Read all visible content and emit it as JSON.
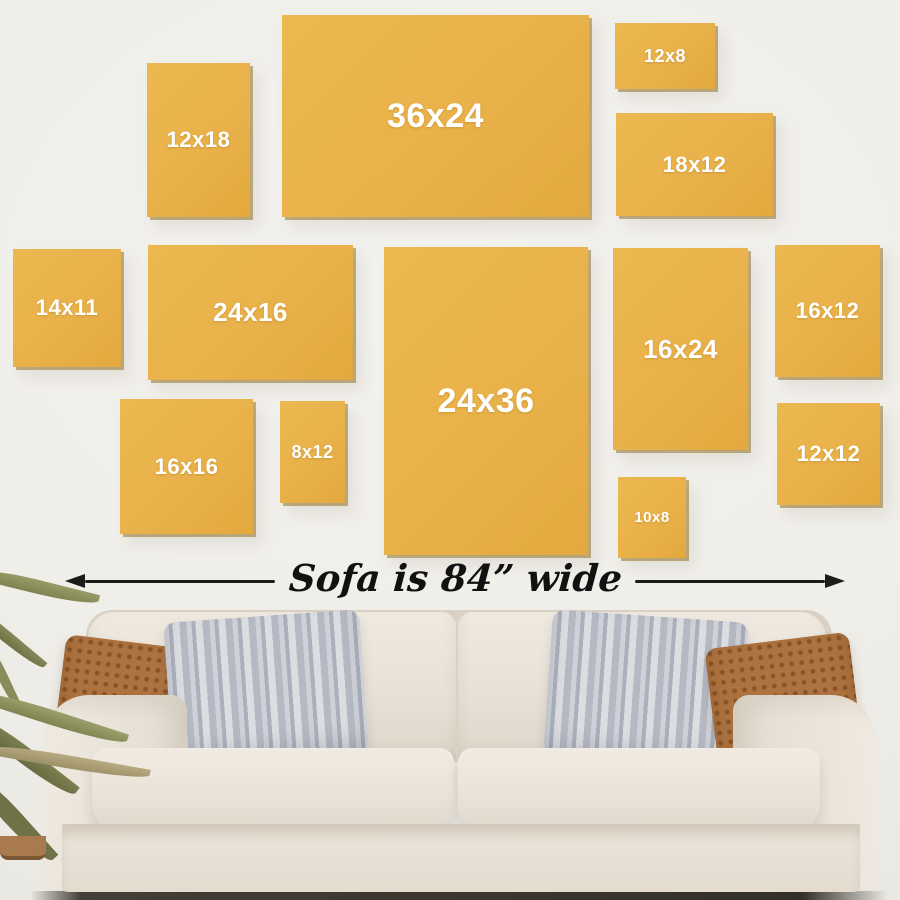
{
  "scene": {
    "description": "Wall art size guide: yellow sample canvases arranged above a sofa",
    "callout": {
      "text": "Sofa is 84” wide"
    }
  },
  "frames": [
    {
      "label": "12x18"
    },
    {
      "label": "36x24"
    },
    {
      "label": "12x8"
    },
    {
      "label": "18x12"
    },
    {
      "label": "14x11"
    },
    {
      "label": "24x16"
    },
    {
      "label": "24x36"
    },
    {
      "label": "16x24"
    },
    {
      "label": "16x12"
    },
    {
      "label": "16x16"
    },
    {
      "label": "8x12"
    },
    {
      "label": "10x8"
    },
    {
      "label": "12x12"
    }
  ],
  "colors": {
    "wall": "#F0EEE9",
    "frame_fill": "#E9B14A",
    "frame_edge_shadow": "#94742C",
    "frame_label": "#FFFFFF",
    "arrow": "#1B1B1B",
    "sofa_body": "#E9E3D9",
    "pillow_brown": "#AC7340",
    "pillow_gray": "#C3C6CD",
    "plant_green": "#7E8351",
    "floor_shadow": "#3A352E"
  }
}
